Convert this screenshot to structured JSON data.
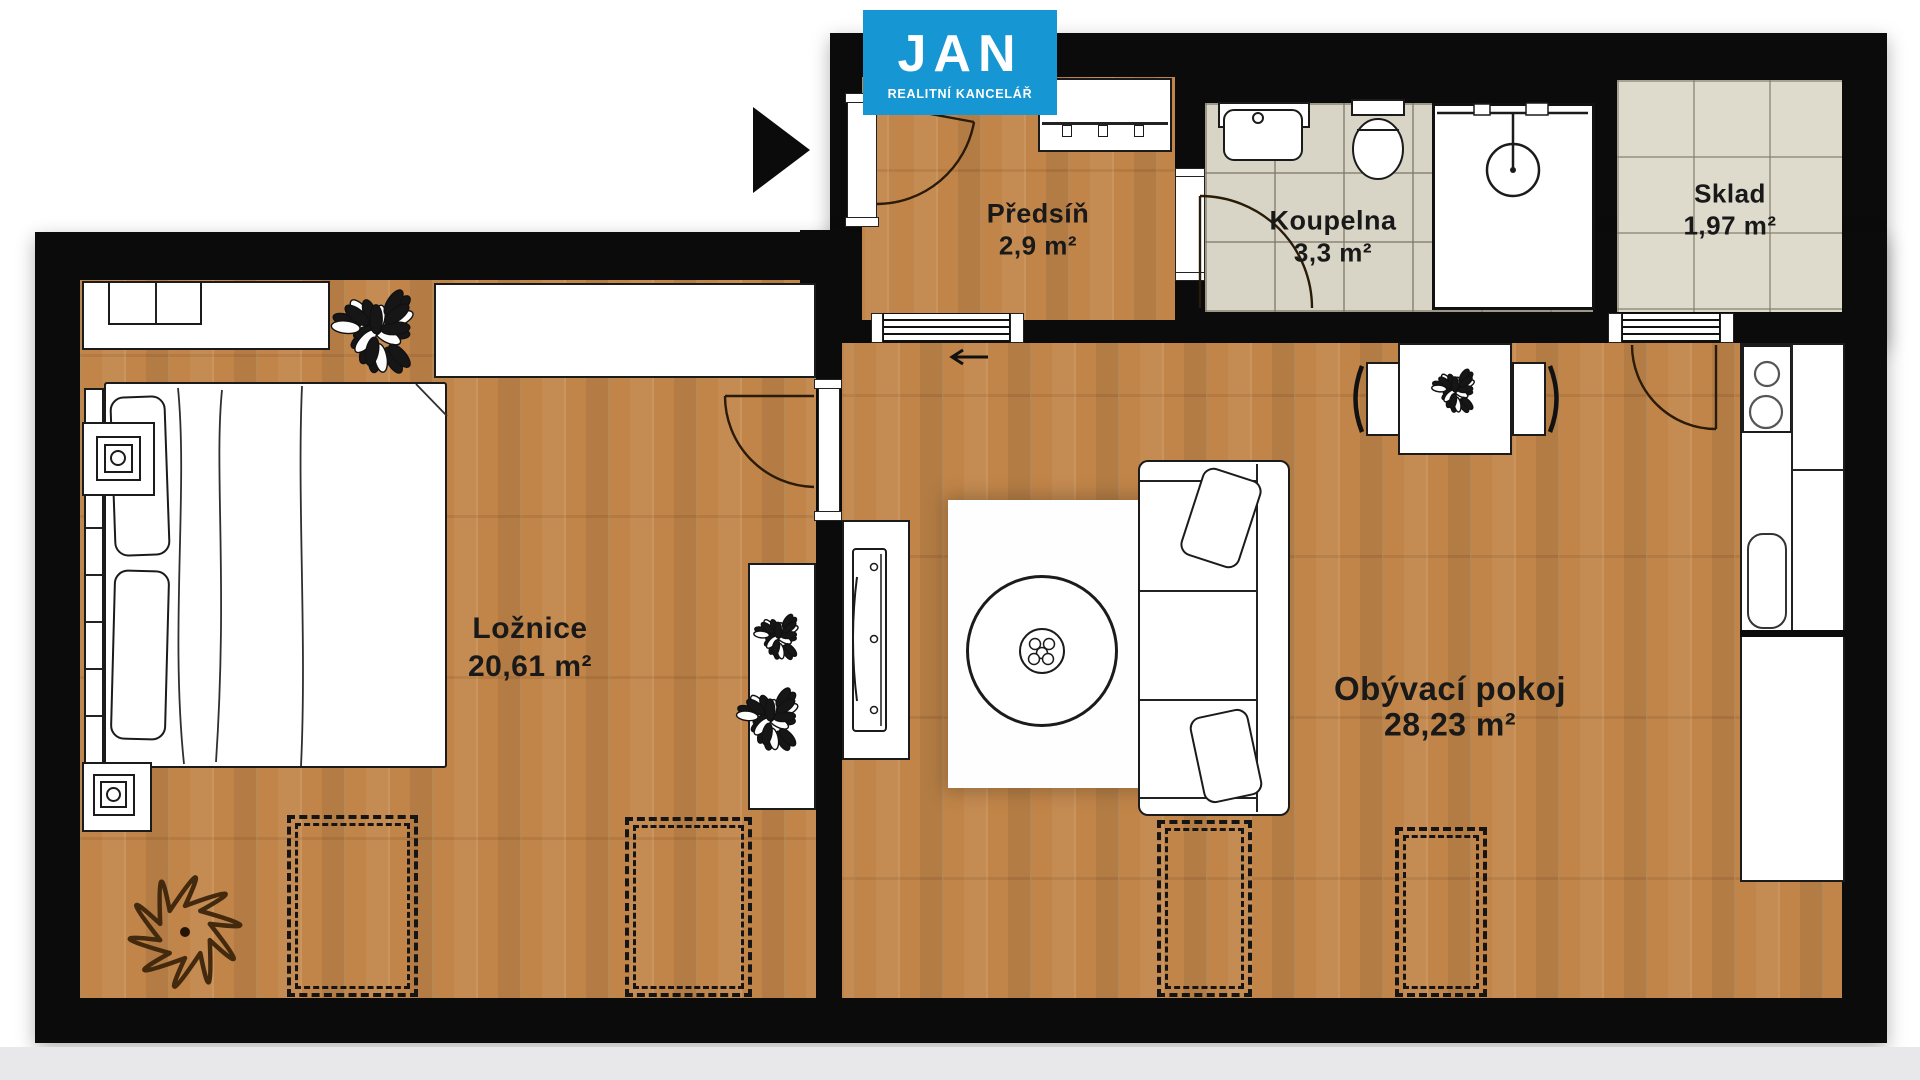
{
  "brand": {
    "name": "JAN",
    "subtitle": "REALITNÍ KANCELÁŘ"
  },
  "rooms": [
    {
      "id": "loznice",
      "name": "Ložnice",
      "area": "20,61 m²"
    },
    {
      "id": "obyvaci-pokoj",
      "name": "Obývací pokoj",
      "area": "28,23 m²"
    },
    {
      "id": "predsin",
      "name": "Předsíň",
      "area": "2,9 m²"
    },
    {
      "id": "koupelna",
      "name": "Koupelna",
      "area": "3,3 m²"
    },
    {
      "id": "sklad",
      "name": "Sklad",
      "area": "1,97 m²"
    }
  ],
  "palette": {
    "logo_bg": "#1697d3",
    "logo_fg": "#ffffff",
    "wall": "#0b0b0b",
    "wood_floor": "#c18549",
    "tile_floor": "#d9d5c6",
    "storage_tile_floor": "#dfdbcc",
    "label_text": "#191919",
    "door_arc": "#2a1a08",
    "bottom_shadow": "#e8e8ea"
  },
  "furniture_icons": [
    "entrance-arrow-icon",
    "double-bed-icon",
    "headboard-icon",
    "wardrobe-icon",
    "built-in-cabinet-icon",
    "nightstand-lamp-icon",
    "plant-icon",
    "flower-rug-icon",
    "console-shelf-icon",
    "tv-stand-icon",
    "tv-icon",
    "sofa-icon",
    "cushion-icon",
    "round-coffee-table-icon",
    "area-rug-icon",
    "dining-table-icon",
    "chair-icon",
    "kitchen-counter-icon",
    "stove-icon",
    "kitchen-sink-icon",
    "washbasin-icon",
    "toilet-icon",
    "shower-icon",
    "hall-wardrobe-icon",
    "door-swing-icon",
    "sliding-door-icon",
    "radiator-dashed-zone"
  ]
}
